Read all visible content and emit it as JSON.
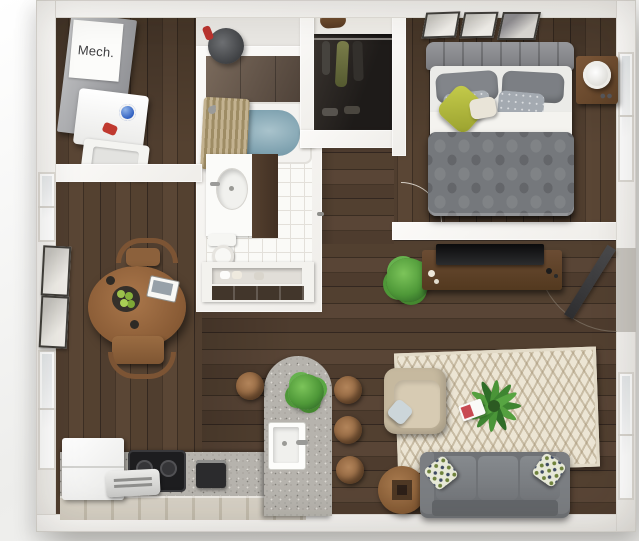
{
  "scene": {
    "title": "3D one-bedroom apartment floor plan render",
    "mech_label": "Mech."
  },
  "rooms": [
    {
      "name": "laundry-mechanical-area",
      "furniture": [
        "mech-closet",
        "washer",
        "dryer",
        "floor-fan"
      ]
    },
    {
      "name": "bathroom",
      "furniture": [
        "bathtub",
        "shower-curtain",
        "vanity-sink",
        "toilet",
        "towel-shelf"
      ]
    },
    {
      "name": "closet",
      "furniture": [
        "shelf",
        "duffel-bag",
        "hanging-clothes",
        "shoes"
      ]
    },
    {
      "name": "bedroom",
      "furniture": [
        "bed",
        "headboard",
        "pillows",
        "green-accent-pillow",
        "duvet",
        "nightstand",
        "table-lamp",
        "wall-frames",
        "window"
      ]
    },
    {
      "name": "dining-area",
      "furniture": [
        "round-table",
        "chairs",
        "fruit-bowl",
        "tablet",
        "mugs",
        "wall-frames",
        "windows"
      ]
    },
    {
      "name": "kitchen",
      "furniture": [
        "refrigerator",
        "cooktop",
        "toaster",
        "coffee-maker",
        "counter",
        "island",
        "island-sink",
        "island-plant",
        "bar-stools"
      ]
    },
    {
      "name": "living-room",
      "furniture": [
        "sofa",
        "sofa-pillows",
        "armchair",
        "throw-pillow",
        "chevron-rug",
        "coffee-table",
        "palm-plant",
        "magazine",
        "tv-console",
        "tv",
        "console-plant",
        "entry-door",
        "window"
      ]
    },
    {
      "name": "hallway",
      "furniture": [
        "bathroom-door",
        "bedroom-door-swing"
      ]
    }
  ],
  "colors": {
    "wall_white": "#f6f5f2",
    "floor_wood": "#4a392c",
    "bath_tile": "#fafaf7",
    "counter_granite": "#b6b3ad",
    "sofa_gray": "#74777b",
    "bed_gray": "#75787c",
    "accent_green_pillow": "#b9c046",
    "plant_green": "#4e9838",
    "armchair_beige": "#c6b99f",
    "rug_cream": "#eae3d2",
    "wood_furniture": "#8a5f3a",
    "tub_water": "#7fa3b2",
    "closet_dark": "#272320"
  }
}
